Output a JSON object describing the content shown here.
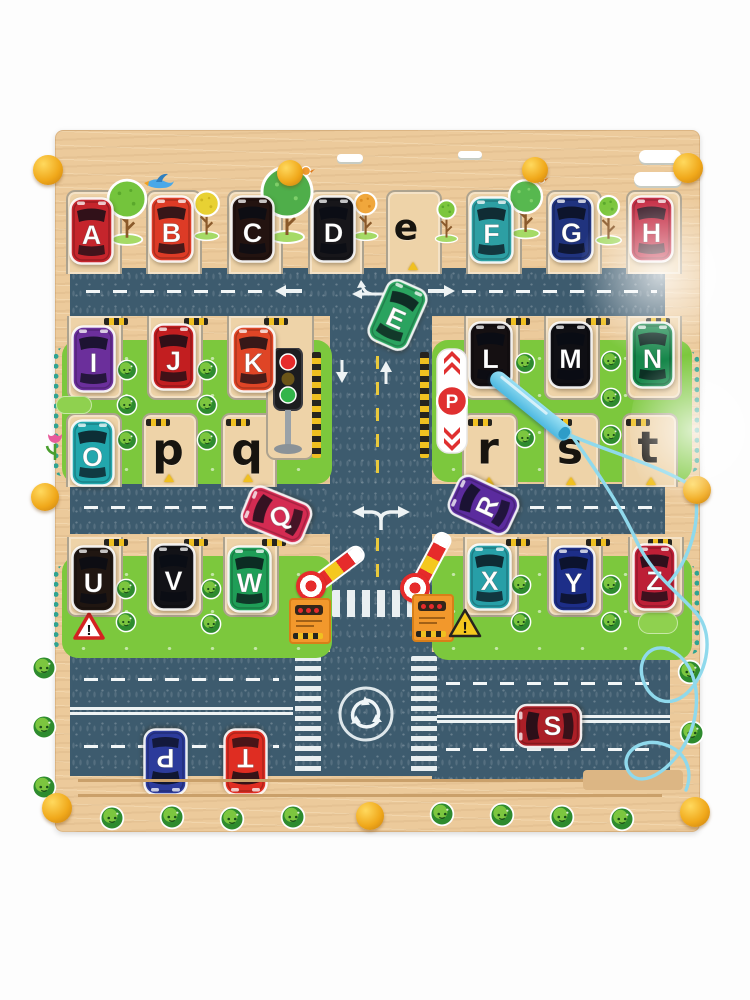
{
  "product": "wooden magnetic alphabet maze traffic board",
  "colors": {
    "wood": "#ecca9b",
    "wood_slot": "#eed3a8",
    "road": "#3d5b6e",
    "grass": "#7cc83d",
    "teal_trim": "#2fa391",
    "knob_yellow": "#f0a81a",
    "pen_blue": "#56c5e8",
    "cord_blue": "#8fd9ec",
    "lane_yellow": "#e9c93c",
    "hazard_yellow": "#f0c020"
  },
  "signs": {
    "parking": "P",
    "warning_red": "!",
    "warning_yellow": "!"
  },
  "cars": [
    {
      "letter": "A",
      "color": "#c5252c",
      "x": 69,
      "y": 197,
      "rot": 0,
      "letter_rot": 0
    },
    {
      "letter": "B",
      "color": "#dd3b26",
      "x": 149,
      "y": 195,
      "rot": 0,
      "letter_rot": 0
    },
    {
      "letter": "C",
      "color": "#231310",
      "x": 230,
      "y": 195,
      "rot": 0,
      "letter_rot": 0
    },
    {
      "letter": "D",
      "color": "#17161a",
      "x": 311,
      "y": 195,
      "rot": 0,
      "letter_rot": 0
    },
    {
      "letter": "E",
      "color": "#2aa35f",
      "x": 375,
      "y": 281,
      "rot": 24,
      "letter_rot": 0
    },
    {
      "letter": "F",
      "color": "#2d9fa3",
      "x": 469,
      "y": 196,
      "rot": 0,
      "letter_rot": 0
    },
    {
      "letter": "G",
      "color": "#20337e",
      "x": 549,
      "y": 195,
      "rot": 0,
      "letter_rot": 0
    },
    {
      "letter": "H",
      "color": "#c11f38",
      "x": 629,
      "y": 195,
      "rot": 0,
      "letter_rot": 0
    },
    {
      "letter": "I",
      "color": "#6b2f9b",
      "x": 71,
      "y": 325,
      "rot": 0,
      "letter_rot": 0
    },
    {
      "letter": "J",
      "color": "#c21e20",
      "x": 151,
      "y": 323,
      "rot": 0,
      "letter_rot": 0
    },
    {
      "letter": "K",
      "color": "#df4526",
      "x": 231,
      "y": 325,
      "rot": 0,
      "letter_rot": 0
    },
    {
      "letter": "L",
      "color": "#151012",
      "x": 468,
      "y": 321,
      "rot": 0,
      "letter_rot": 0
    },
    {
      "letter": "M",
      "color": "#0f0f14",
      "x": 548,
      "y": 321,
      "rot": 0,
      "letter_rot": 0
    },
    {
      "letter": "N",
      "color": "#17874b",
      "x": 630,
      "y": 321,
      "rot": 0,
      "letter_rot": 0
    },
    {
      "letter": "O",
      "color": "#22a7ad",
      "x": 70,
      "y": 419,
      "rot": 0,
      "letter_rot": 0
    },
    {
      "letter": "P",
      "color": "#2c3b9b",
      "x": 143,
      "y": 728,
      "rot": 180,
      "letter_rot": 0
    },
    {
      "letter": "Q",
      "color": "#d42b52",
      "x": 254,
      "y": 481,
      "rot": -68,
      "letter_rot": 50
    },
    {
      "letter": "R",
      "color": "#5b2b9e",
      "x": 461,
      "y": 471,
      "rot": -65,
      "letter_rot": 0
    },
    {
      "letter": "S",
      "color": "#ab1f27",
      "x": 526,
      "y": 692,
      "rot": -90,
      "letter_rot": 90
    },
    {
      "letter": "T",
      "color": "#df2d22",
      "x": 223,
      "y": 728,
      "rot": 180,
      "letter_rot": 0
    },
    {
      "letter": "U",
      "color": "#201611",
      "x": 71,
      "y": 545,
      "rot": 0,
      "letter_rot": 0
    },
    {
      "letter": "V",
      "color": "#121217",
      "x": 151,
      "y": 543,
      "rot": 0,
      "letter_rot": 0
    },
    {
      "letter": "W",
      "color": "#1f9e57",
      "x": 227,
      "y": 545,
      "rot": 0,
      "letter_rot": 0
    },
    {
      "letter": "X",
      "color": "#279fa7",
      "x": 467,
      "y": 543,
      "rot": 0,
      "letter_rot": 0
    },
    {
      "letter": "Y",
      "color": "#1d2e88",
      "x": 551,
      "y": 545,
      "rot": 0,
      "letter_rot": 0
    },
    {
      "letter": "Z",
      "color": "#bd1f36",
      "x": 632,
      "y": 543,
      "rot": 0,
      "letter_rot": 0
    }
  ],
  "slot_letters": [
    {
      "letter": "e",
      "x": 406,
      "y": 228,
      "size": 36
    },
    {
      "letter": "p",
      "x": 168,
      "y": 450,
      "size": 44
    },
    {
      "letter": "q",
      "x": 247,
      "y": 450,
      "size": 44
    },
    {
      "letter": "r",
      "x": 488,
      "y": 449,
      "size": 44
    },
    {
      "letter": "s",
      "x": 570,
      "y": 449,
      "size": 44
    },
    {
      "letter": "t",
      "x": 648,
      "y": 448,
      "size": 44
    }
  ],
  "decor": {
    "trees": [
      {
        "type": "green",
        "x": 127,
        "y": 172,
        "s": 0.9,
        "bird": false
      },
      {
        "type": "yellow",
        "x": 207,
        "y": 182,
        "s": 0.72,
        "bird": false
      },
      {
        "type": "green-big",
        "x": 287,
        "y": 162,
        "s": 1.0,
        "bird": true
      },
      {
        "type": "orange",
        "x": 366,
        "y": 182,
        "s": 0.72,
        "bird": false
      },
      {
        "type": "green-small",
        "x": 446,
        "y": 190,
        "s": 0.65,
        "bird": false
      },
      {
        "type": "green-round",
        "x": 526,
        "y": 172,
        "s": 0.82,
        "bird": true
      },
      {
        "type": "green-small",
        "x": 608,
        "y": 184,
        "s": 0.75,
        "bird": false
      }
    ],
    "clouds": [
      {
        "x": 350,
        "y": 154,
        "w": 26
      },
      {
        "x": 470,
        "y": 151,
        "w": 24
      },
      {
        "x": 660,
        "y": 150,
        "w": 42
      },
      {
        "x": 658,
        "y": 172,
        "w": 48
      }
    ],
    "birds": [
      {
        "x": 158,
        "y": 170,
        "type": "blue"
      }
    ],
    "knobs": [
      {
        "x": 48,
        "y": 170,
        "r": 15
      },
      {
        "x": 290,
        "y": 173,
        "r": 13
      },
      {
        "x": 535,
        "y": 170,
        "r": 13
      },
      {
        "x": 688,
        "y": 168,
        "r": 15
      },
      {
        "x": 45,
        "y": 497,
        "r": 14
      },
      {
        "x": 697,
        "y": 490,
        "r": 14
      },
      {
        "x": 57,
        "y": 808,
        "r": 15
      },
      {
        "x": 370,
        "y": 816,
        "r": 14
      },
      {
        "x": 695,
        "y": 812,
        "r": 15
      }
    ],
    "bushes_frame": [
      [
        44,
        668
      ],
      [
        44,
        727
      ],
      [
        44,
        787
      ],
      [
        112,
        818
      ],
      [
        172,
        817
      ],
      [
        232,
        819
      ],
      [
        293,
        817
      ],
      [
        442,
        814
      ],
      [
        502,
        815
      ],
      [
        562,
        817
      ],
      [
        622,
        819
      ],
      [
        690,
        672
      ],
      [
        692,
        733
      ]
    ],
    "bushes_blocks": [
      [
        127,
        370
      ],
      [
        207,
        370
      ],
      [
        127,
        405
      ],
      [
        207,
        405
      ],
      [
        127,
        440
      ],
      [
        207,
        440
      ],
      [
        525,
        363
      ],
      [
        611,
        361
      ],
      [
        611,
        398
      ],
      [
        525,
        438
      ],
      [
        611,
        435
      ],
      [
        126,
        589
      ],
      [
        211,
        589
      ],
      [
        126,
        622
      ],
      [
        211,
        624
      ],
      [
        521,
        585
      ],
      [
        611,
        585
      ],
      [
        521,
        622
      ],
      [
        611,
        622
      ]
    ]
  }
}
